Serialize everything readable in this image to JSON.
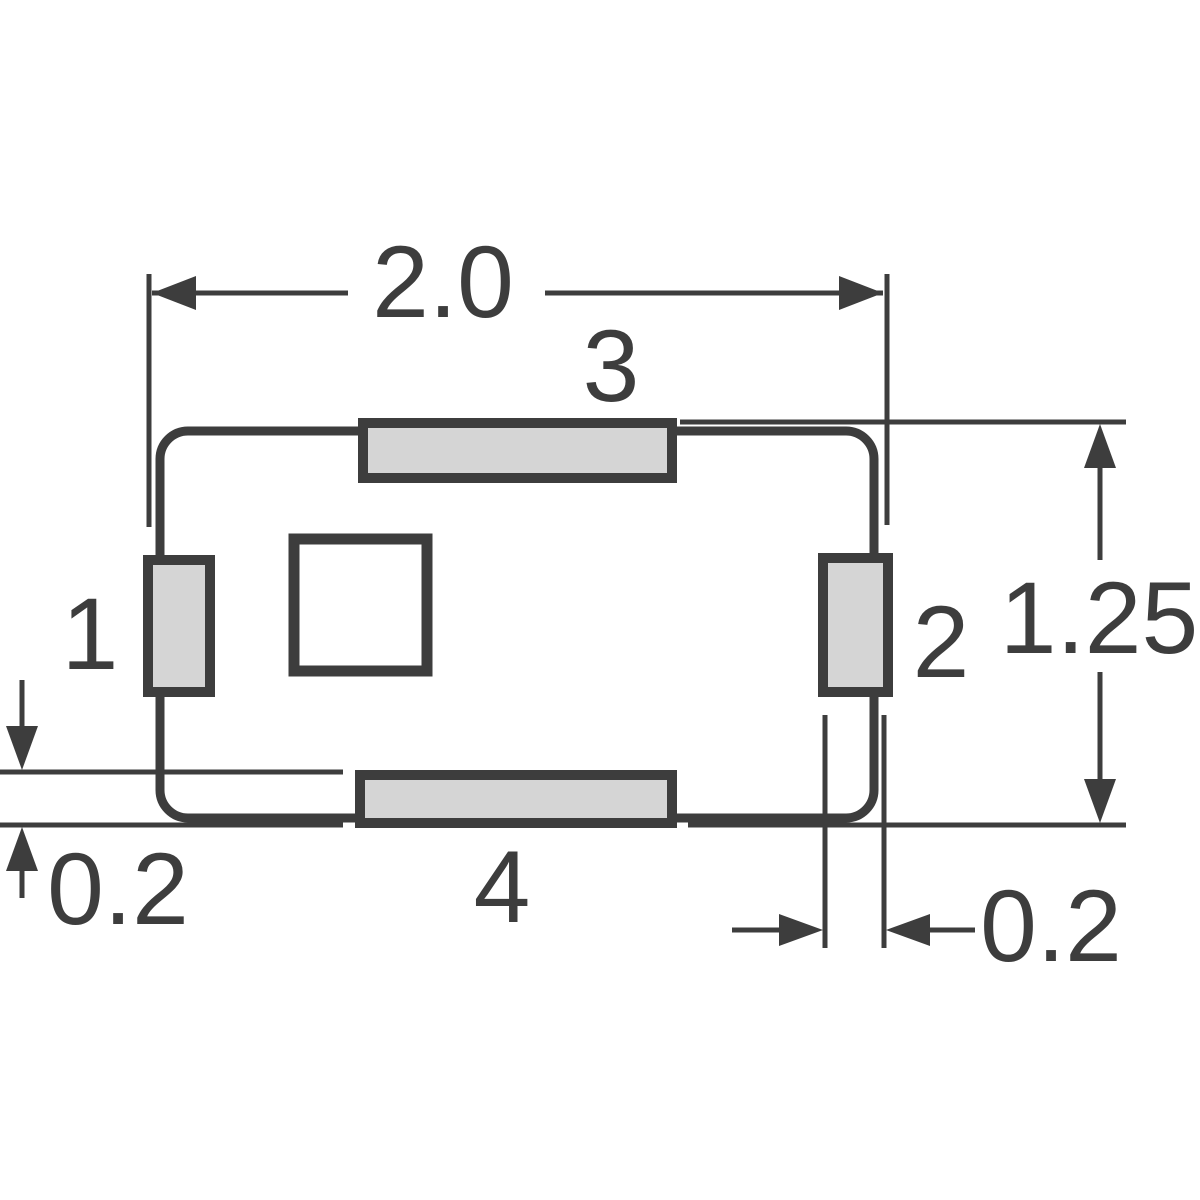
{
  "drawing": {
    "pad_labels": {
      "pad1": "1",
      "pad2": "2",
      "pad3": "3",
      "pad4": "4"
    },
    "dimensions": {
      "overall_width": "2.0",
      "overall_height": "1.25",
      "bottom_left_offset": "0.2",
      "bottom_right_offset": "0.2"
    },
    "colors": {
      "line": "#3d3d3d",
      "pad_fill": "#d5d5d5",
      "body_fill": "#ffffff",
      "text": "#3d3d3d"
    }
  }
}
